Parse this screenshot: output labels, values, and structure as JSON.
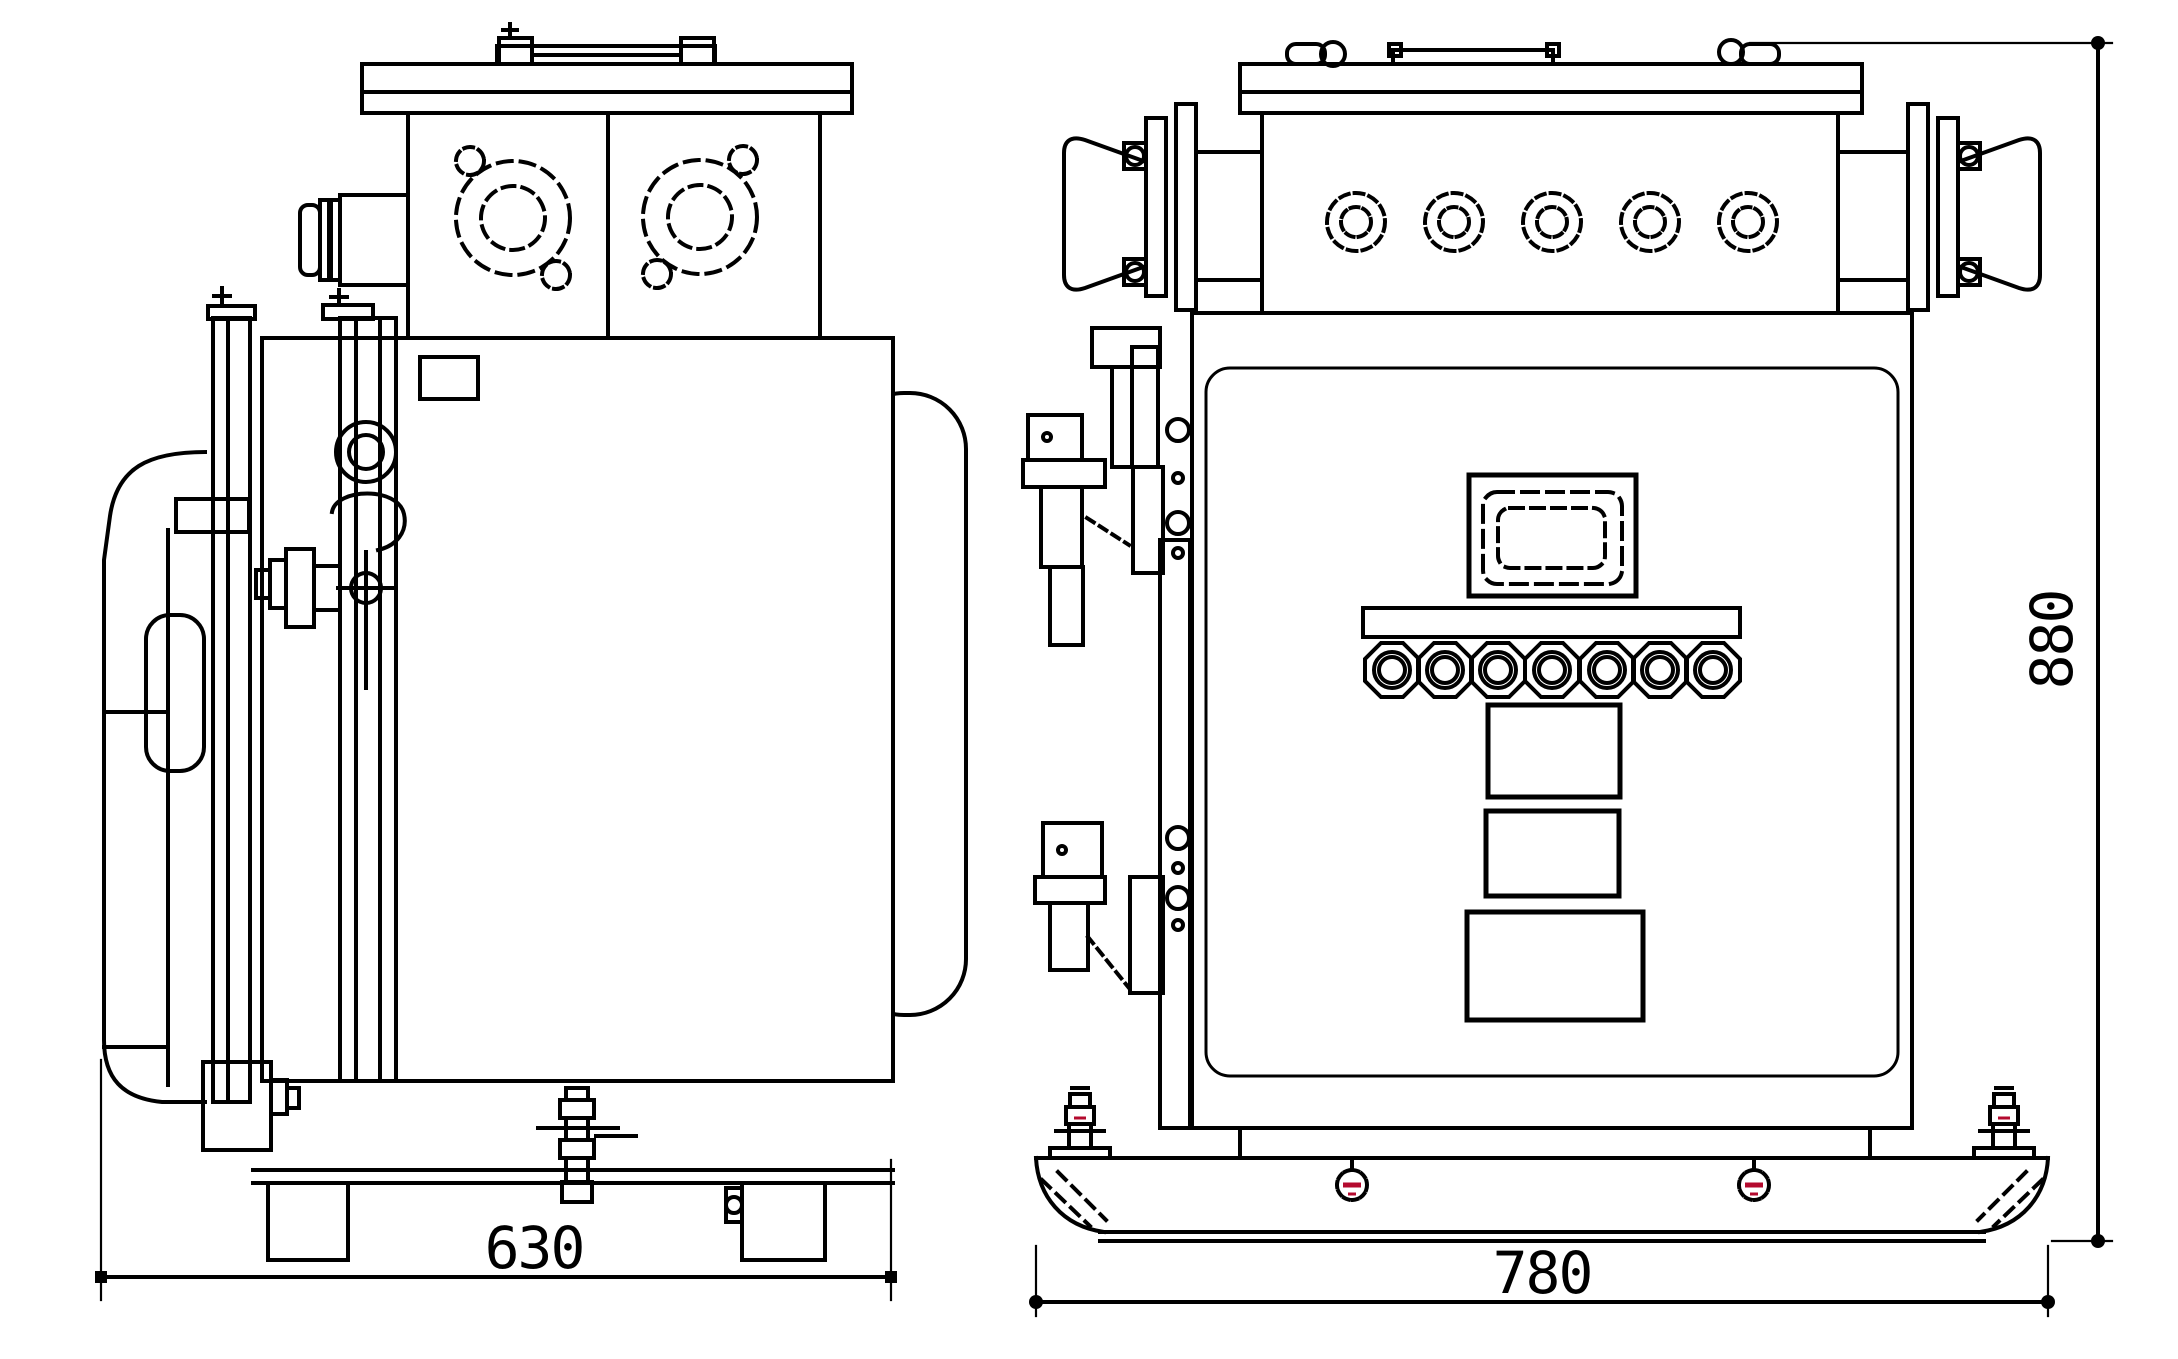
{
  "canvas": {
    "width": 2178,
    "height": 1359,
    "background": "#ffffff"
  },
  "colors": {
    "line": "#000000",
    "accent_red": "#b40a2e"
  },
  "dimensions": {
    "side_width": {
      "value": "630",
      "orientation": "horizontal",
      "view": "side"
    },
    "front_width": {
      "value": "780",
      "orientation": "horizontal",
      "view": "front"
    },
    "front_height": {
      "value": "880",
      "orientation": "vertical",
      "view": "front"
    }
  },
  "features": {
    "side_view": {
      "flanged_ports": 2,
      "port_bolt_ears_per_flange": 2,
      "side_cable_entry": 1,
      "door_handle": 1,
      "interlock_ring": 1,
      "base_feet": 2,
      "center_clamp": 1
    },
    "front_view": {
      "top_cable_glands": 5,
      "side_horn_connectors": 2,
      "display_window": 1,
      "indicator_row_count": 7,
      "panel_buttons": 3,
      "hinge_bolt_groups": 2,
      "foot_bolts": 2,
      "red_marked_base_screws": 2
    }
  }
}
